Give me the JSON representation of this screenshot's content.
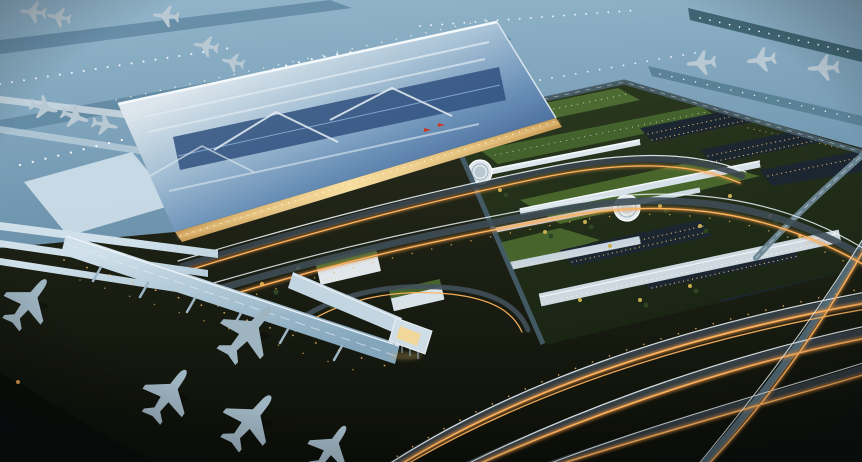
{
  "image": {
    "description": "Aerial dusk rendering of a large international airport: a silver-roofed terminal with warm lit facade, concourse pier with jet bridges and parked aircraft on dark apron, blue twilight airfield with taxiway lights and a runway, a landside complex with green roofs, parking lots, white canopies and circular plazas, and highways streaked with orange light trails.",
    "alt": "Aerial rendering of an airport at dusk"
  },
  "palette": {
    "sky_top": "#93b6cb",
    "apron_blue": "#6e94ae",
    "apron_deep": "#4e7289",
    "taxiway_teal": "#3f6472",
    "runway_light": "#577e93",
    "roof_light": "#dce6ec",
    "roof_mid": "#6b91b8",
    "roof_dark": "#35568a",
    "facade_warm": "#f7dfa2",
    "facade_deep": "#c89a55",
    "canopy_white": "#dde6ec",
    "pier_light": "#cfe0ea",
    "pier_mid": "#84a6bc",
    "ground_dark": "#2a2e1d",
    "ground_black": "#0c0f08",
    "complex_green": "#2c3a20",
    "lawn_green": "#4f7030",
    "roofgarden_green": "#4c6a31",
    "tree_dark": "#2e4522",
    "tree_lit": "#c8ad52",
    "parking_dark": "#1c2630",
    "road_deck": "#39454e",
    "ramp_deck": "#55707e",
    "trail_orange": "#ffb45e",
    "trail_orange_glow": "#e89040",
    "trail_white": "#e8f0f5",
    "light_white": "#ffffff",
    "lamp_warm": "#f0b667",
    "aircraft_light": "#b9c9d3",
    "aircraft_apron": "#9eb4c1",
    "flag_red": "#c63b28"
  },
  "scene": {
    "regions": [
      {
        "name": "airfield-aprons",
        "description": "blue twilight aprons and taxiways with white centerline lights and parked aircraft"
      },
      {
        "name": "runway",
        "description": "diagonal runway with edge lights, three aircraft queued on parallel taxiway"
      },
      {
        "name": "terminal",
        "description": "large metallic blue-silver terminal roof with skylight strips, warm lit facade and two small red flags"
      },
      {
        "name": "concourse-pier",
        "description": "long pier with jet bridges and five large aircraft on dark apron"
      },
      {
        "name": "landside-complex",
        "description": "green roof gardens, lawns, parking lots with lit cars and trees, white canopy buildings, two circular plazas"
      },
      {
        "name": "highways",
        "description": "multi-lane roads and ramps with orange and white vehicle light trails"
      }
    ]
  }
}
